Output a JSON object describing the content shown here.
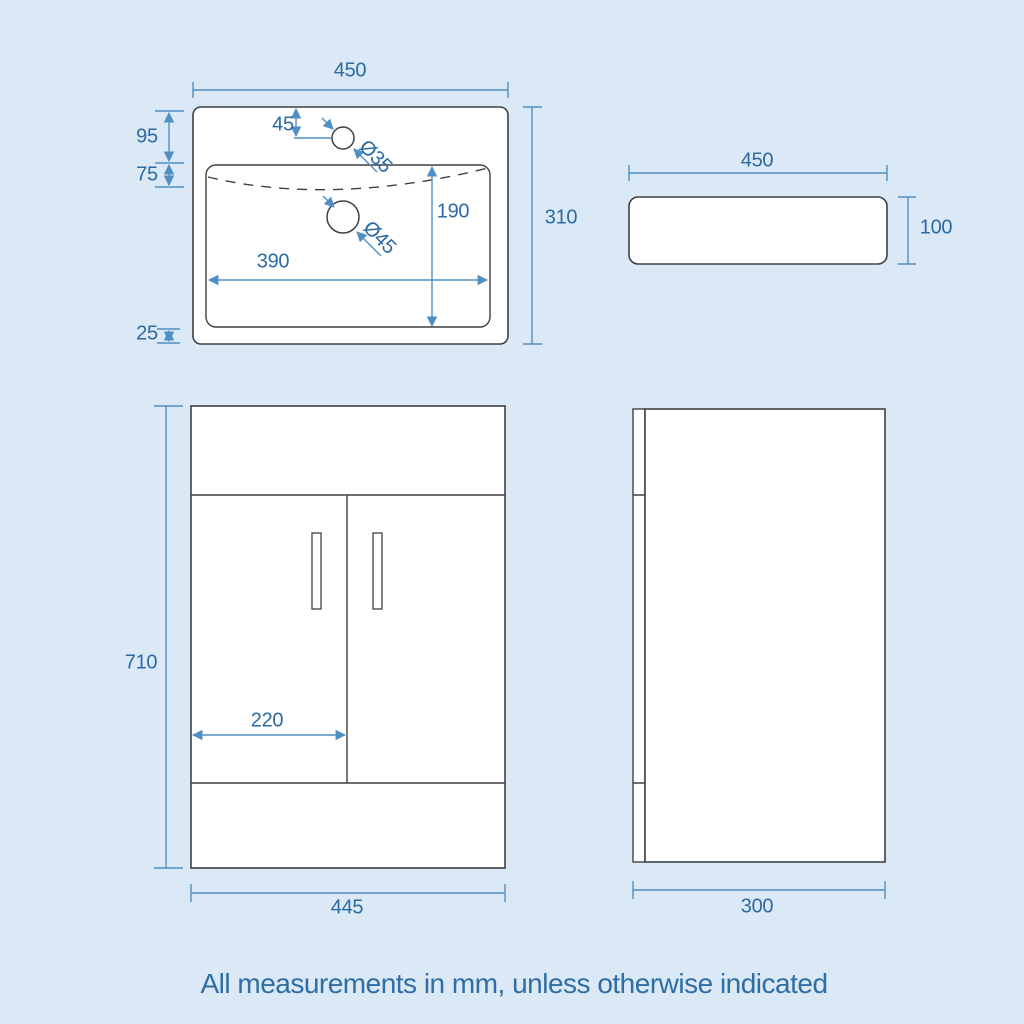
{
  "colors": {
    "background": "#dbe8f5",
    "outline": "#3d4144",
    "dimension_line": "#4f8fc4",
    "dimension_text": "#2b6aa4"
  },
  "caption": "All measurements in mm, unless otherwise indicated",
  "labels": {
    "basin_plan": {
      "width": "450",
      "height": "310",
      "tap_setback": "95",
      "rim_depth": "75",
      "bottom_gap": "25",
      "tap_inset": "45",
      "tap_hole_dia": "Ø35",
      "waste_hole_dia": "Ø45",
      "bowl_depth": "190",
      "bowl_width": "390"
    },
    "basin_side": {
      "width": "450",
      "height": "100"
    },
    "cabinet_front": {
      "height": "710",
      "door_width": "220",
      "width": "445"
    },
    "cabinet_side": {
      "depth": "300"
    }
  }
}
